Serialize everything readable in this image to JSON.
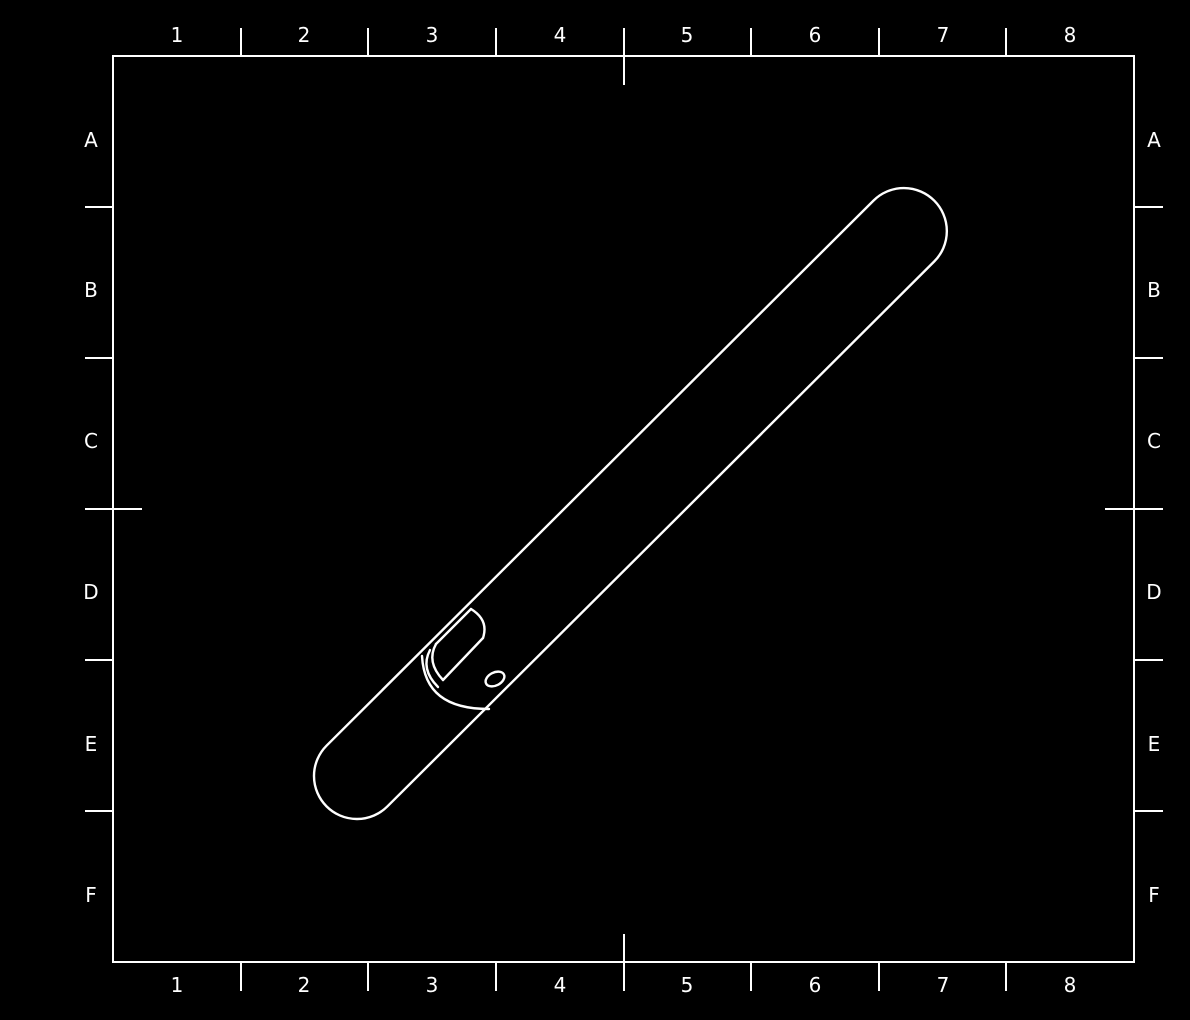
{
  "canvas": {
    "background_color": "#000000",
    "line_color": "#ffffff"
  },
  "grid": {
    "columns": [
      "1",
      "2",
      "3",
      "4",
      "5",
      "6",
      "7",
      "8"
    ],
    "rows": [
      "A",
      "B",
      "C",
      "D",
      "E",
      "F"
    ]
  }
}
